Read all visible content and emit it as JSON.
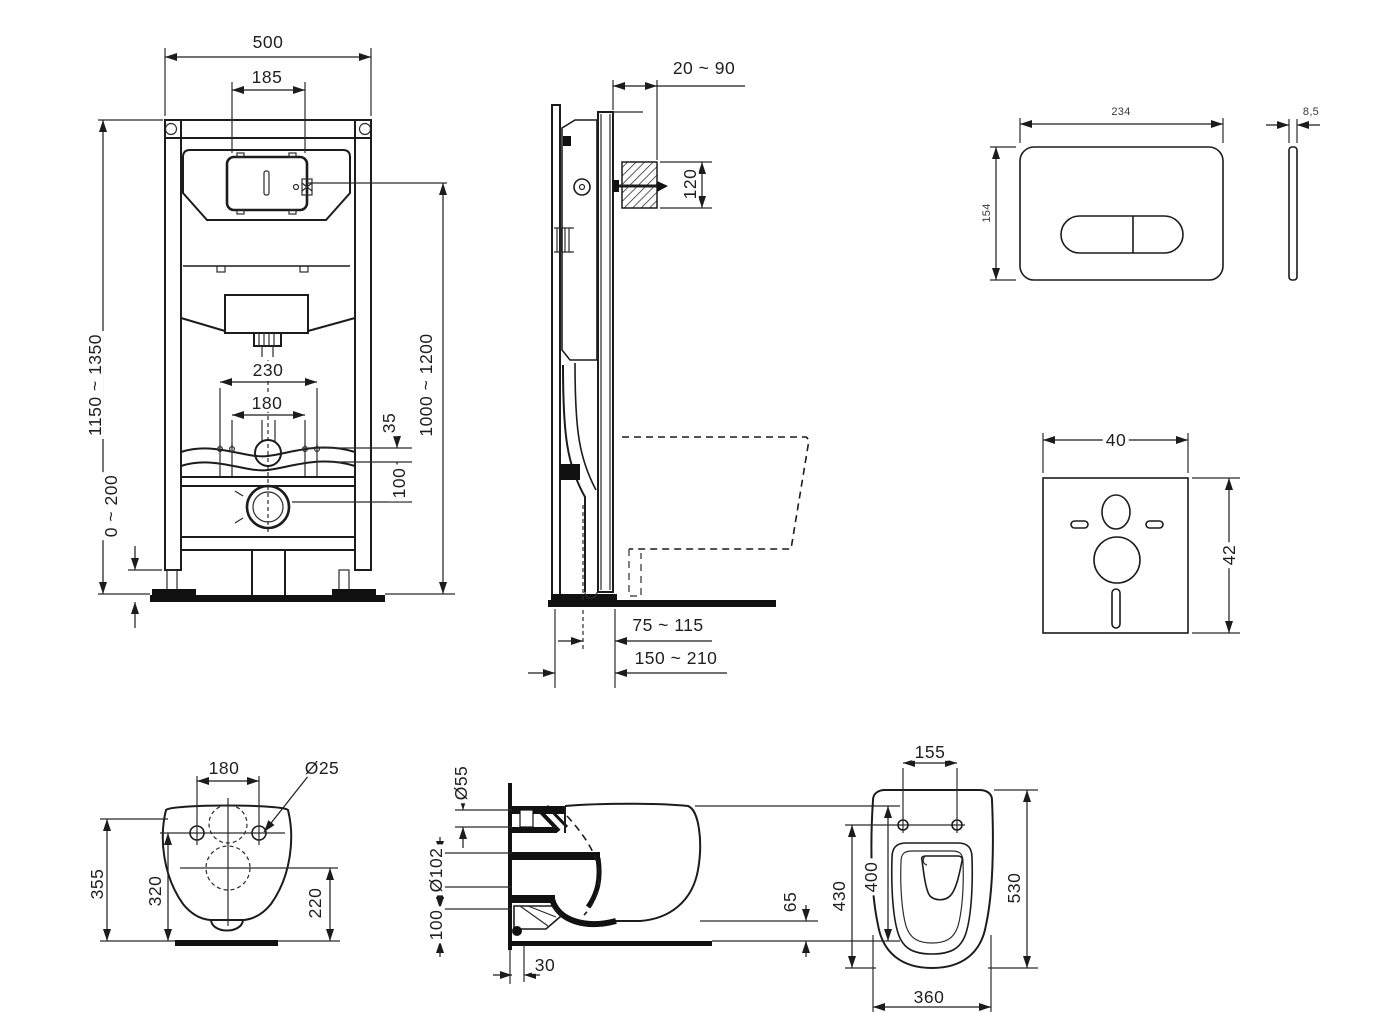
{
  "views": {
    "frame_front": {
      "title": "installation-frame-front-view",
      "dims": {
        "total_width": "500",
        "access_opening_width": "185",
        "frame_height_range": "1150 ~ 1350",
        "leg_adjustment_range": "0 ~ 200",
        "flush_pipe_height_range": "1000 ~ 1200",
        "outer_fixing_spacing": "230",
        "inner_fixing_spacing": "180",
        "bracket_offset": "35",
        "drain_offset": "100"
      }
    },
    "frame_side": {
      "title": "installation-frame-side-view",
      "dims": {
        "wall_distance_range": "20 ~ 90",
        "inlet_opening_height": "120",
        "drain_axis_range": "75 ~ 115",
        "frame_depth_range": "150 ~ 210"
      }
    },
    "flush_plate": {
      "title": "flush-plate-views",
      "dims": {
        "width": "234",
        "height": "154",
        "thickness": "8,5"
      }
    },
    "sound_pad": {
      "title": "sound-insulation-pad",
      "dims": {
        "width": "40",
        "height": "42"
      }
    },
    "bowl_back": {
      "title": "wc-bowl-rear-view",
      "dims": {
        "fixing_hole_spacing": "180",
        "fixing_hole_diameter": "Ø25",
        "total_height": "355",
        "hole_line_height": "320",
        "outlet_height": "220"
      }
    },
    "bowl_side": {
      "title": "wc-bowl-side-view",
      "dims": {
        "flush_inlet_diameter": "Ø55",
        "outlet_diameter": "Ø102",
        "outlet_axis_height": "100",
        "wall_clearance": "30",
        "rim_clearance": "65",
        "bowl_height": "400"
      }
    },
    "bowl_top": {
      "title": "wc-bowl-top-view",
      "dims": {
        "seat_fixing_spacing": "155",
        "bowl_depth": "530",
        "inner_depth": "430",
        "bowl_width": "360"
      }
    }
  }
}
